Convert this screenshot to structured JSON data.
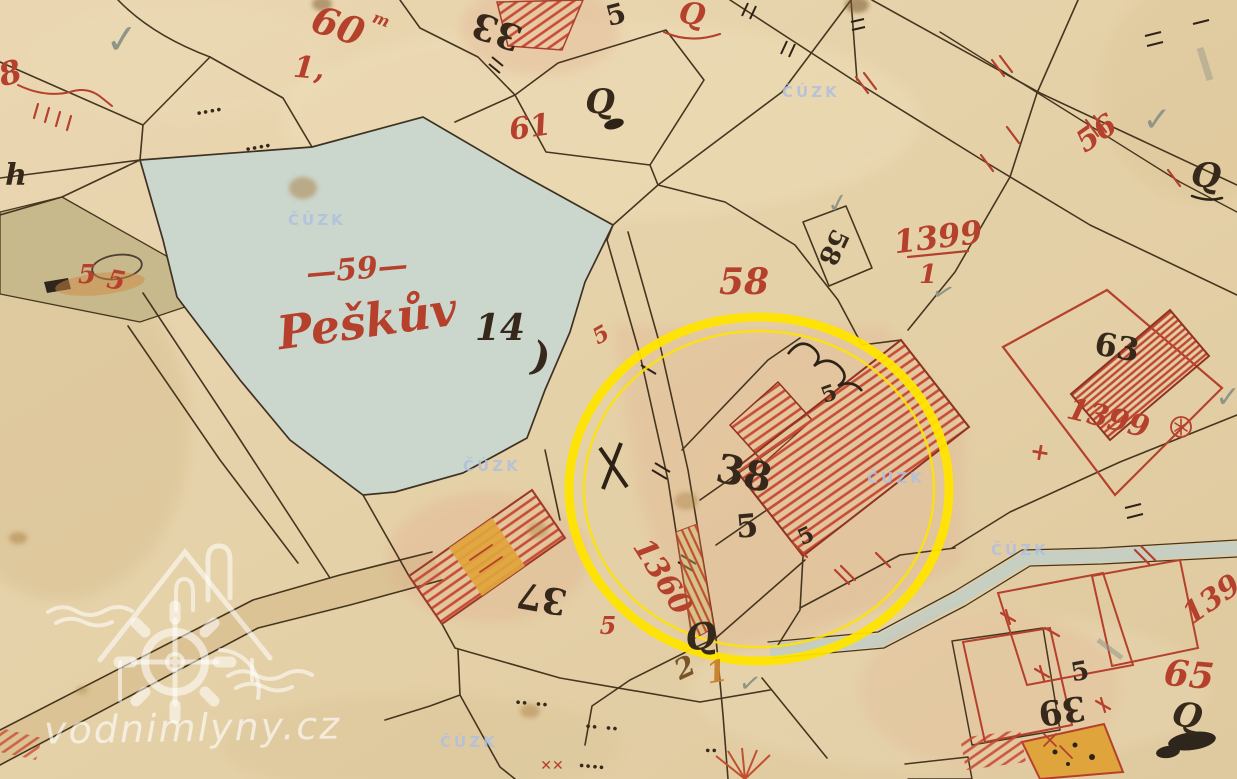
{
  "map": {
    "kind": "historical-cadastral-map",
    "pond_label": {
      "dash_number": "—59—",
      "name": "Peškův",
      "ref": "14)"
    },
    "annotation": {
      "shape": "ellipse",
      "purpose": "highlight of parcel 38 with building",
      "color": "#ffe400"
    },
    "labels": [
      {
        "t": "60",
        "x": 338,
        "y": 26,
        "r": 18,
        "s": 38,
        "c": "red",
        "i": true
      },
      {
        "t": "m",
        "x": 381,
        "y": 20,
        "r": 20,
        "s": 16,
        "c": "red",
        "i": true
      },
      {
        "t": "1,",
        "x": 309,
        "y": 69,
        "r": 5,
        "s": 30,
        "c": "red",
        "i": true
      },
      {
        "t": "33",
        "x": 497,
        "y": 31,
        "r": 200,
        "s": 36,
        "c": "black"
      },
      {
        "t": "5",
        "x": 616,
        "y": 15,
        "r": -15,
        "s": 28,
        "c": "black"
      },
      {
        "t": "Q",
        "x": 692,
        "y": 15,
        "r": 8,
        "s": 30,
        "c": "red",
        "i": true
      },
      {
        "t": "Q",
        "x": 600,
        "y": 102,
        "r": 0,
        "s": 34,
        "c": "black",
        "i": true
      },
      {
        "t": "61",
        "x": 530,
        "y": 128,
        "r": -8,
        "s": 30,
        "c": "red",
        "i": true
      },
      {
        "t": "56",
        "x": 1097,
        "y": 134,
        "r": -35,
        "s": 30,
        "c": "red",
        "i": true
      },
      {
        "t": "Q",
        "x": 1206,
        "y": 176,
        "r": 5,
        "s": 34,
        "c": "black",
        "i": true
      },
      {
        "t": "✓",
        "x": 122,
        "y": 40,
        "r": -5,
        "s": 40,
        "c": "gray"
      },
      {
        "t": "✓",
        "x": 1157,
        "y": 120,
        "r": 0,
        "s": 34,
        "c": "gray"
      },
      {
        "t": "✓",
        "x": 838,
        "y": 204,
        "r": -10,
        "s": 26,
        "c": "gray"
      },
      {
        "t": "—59—",
        "x": 357,
        "y": 270,
        "r": -5,
        "s": 30,
        "c": "red",
        "i": true
      },
      {
        "t": "Peškův",
        "x": 367,
        "y": 321,
        "r": -8,
        "s": 46,
        "c": "red",
        "i": true
      },
      {
        "t": "14",
        "x": 500,
        "y": 328,
        "r": 0,
        "s": 36,
        "c": "black",
        "i": true
      },
      {
        "t": ")",
        "x": 541,
        "y": 358,
        "r": 15,
        "s": 40,
        "c": "black"
      },
      {
        "t": "58",
        "x": 744,
        "y": 282,
        "r": 0,
        "s": 36,
        "c": "red",
        "i": true
      },
      {
        "t": "58",
        "x": 833,
        "y": 247,
        "r": 115,
        "s": 26,
        "c": "black"
      },
      {
        "t": "1399",
        "x": 938,
        "y": 237,
        "r": -7,
        "s": 32,
        "c": "red",
        "i": true
      },
      {
        "t": "1",
        "x": 928,
        "y": 275,
        "r": 0,
        "s": 26,
        "c": "red",
        "i": true
      },
      {
        "t": "✓",
        "x": 943,
        "y": 293,
        "r": 20,
        "s": 26,
        "c": "gray"
      },
      {
        "t": "63",
        "x": 1117,
        "y": 347,
        "r": 10,
        "s": 32,
        "c": "black"
      },
      {
        "t": "1399",
        "x": 1108,
        "y": 419,
        "r": 14,
        "s": 30,
        "c": "red",
        "i": true
      },
      {
        "t": "+",
        "x": 1040,
        "y": 452,
        "r": 10,
        "s": 24,
        "c": "red"
      },
      {
        "t": "38",
        "x": 744,
        "y": 474,
        "r": 12,
        "s": 40,
        "c": "black"
      },
      {
        "t": "5",
        "x": 747,
        "y": 526,
        "r": -5,
        "s": 32,
        "c": "black"
      },
      {
        "t": "5",
        "x": 806,
        "y": 536,
        "r": -25,
        "s": 22,
        "c": "black"
      },
      {
        "t": "5",
        "x": 829,
        "y": 394,
        "r": -20,
        "s": 22,
        "c": "black"
      },
      {
        "t": "1360",
        "x": 662,
        "y": 577,
        "r": 58,
        "s": 30,
        "c": "red",
        "i": true
      },
      {
        "t": "5",
        "x": 608,
        "y": 626,
        "r": 0,
        "s": 24,
        "c": "red",
        "i": true
      },
      {
        "t": "5",
        "x": 601,
        "y": 335,
        "r": -30,
        "s": 22,
        "c": "red",
        "i": true
      },
      {
        "t": "37",
        "x": 542,
        "y": 598,
        "r": 190,
        "s": 36,
        "c": "black"
      },
      {
        "t": "Q",
        "x": 701,
        "y": 637,
        "r": -10,
        "s": 36,
        "c": "black",
        "i": true
      },
      {
        "t": "2",
        "x": 685,
        "y": 668,
        "r": -25,
        "s": 28,
        "c": "brown",
        "i": true
      },
      {
        "t": "1",
        "x": 717,
        "y": 673,
        "r": -10,
        "s": 30,
        "c": "orange",
        "i": true
      },
      {
        "t": "65",
        "x": 1189,
        "y": 675,
        "r": 5,
        "s": 36,
        "c": "red",
        "i": true
      },
      {
        "t": "Q",
        "x": 1187,
        "y": 716,
        "r": 10,
        "s": 34,
        "c": "black",
        "i": true
      },
      {
        "t": "39",
        "x": 1062,
        "y": 710,
        "r": 172,
        "s": 34,
        "c": "black"
      },
      {
        "t": "5",
        "x": 1080,
        "y": 672,
        "r": -10,
        "s": 26,
        "c": "black"
      },
      {
        "t": "139",
        "x": 1212,
        "y": 600,
        "r": -35,
        "s": 30,
        "c": "red",
        "i": true
      },
      {
        "t": "8",
        "x": 10,
        "y": 73,
        "r": -15,
        "s": 32,
        "c": "red",
        "i": true
      },
      {
        "t": "5",
        "x": 87,
        "y": 275,
        "r": 0,
        "s": 26,
        "c": "red",
        "i": true
      },
      {
        "t": "5",
        "x": 116,
        "y": 281,
        "r": 10,
        "s": 26,
        "c": "red",
        "i": true
      },
      {
        "t": "h",
        "x": 16,
        "y": 176,
        "r": 0,
        "s": 30,
        "c": "black",
        "i": true
      },
      {
        "t": "✓",
        "x": 750,
        "y": 684,
        "r": 10,
        "s": 26,
        "c": "gray"
      },
      {
        "t": "✓",
        "x": 1228,
        "y": 398,
        "r": 0,
        "s": 30,
        "c": "gray"
      },
      {
        "t": "✕✕",
        "x": 552,
        "y": 766,
        "r": 0,
        "s": 14,
        "c": "red"
      },
      {
        "t": "‥‥",
        "x": 208,
        "y": 106,
        "r": -10,
        "s": 20,
        "c": "black"
      },
      {
        "t": "‥‥",
        "x": 257,
        "y": 142,
        "r": -10,
        "s": 20,
        "c": "black"
      },
      {
        "t": "‥ ‥",
        "x": 532,
        "y": 698,
        "r": 5,
        "s": 20,
        "c": "black"
      },
      {
        "t": "‥ ‥",
        "x": 602,
        "y": 722,
        "r": 5,
        "s": 20,
        "c": "black"
      },
      {
        "t": "‥‥",
        "x": 592,
        "y": 761,
        "r": 5,
        "s": 20,
        "c": "black"
      },
      {
        "t": "‥",
        "x": 711,
        "y": 745,
        "r": 0,
        "s": 20,
        "c": "black"
      }
    ]
  },
  "watermarks": {
    "site": {
      "text": "vodnimlyny.cz"
    },
    "cuzk": {
      "text": "ČÚZK",
      "positions": [
        {
          "x": 318,
          "y": 220
        },
        {
          "x": 812,
          "y": 92
        },
        {
          "x": 493,
          "y": 466
        },
        {
          "x": 897,
          "y": 478
        },
        {
          "x": 1021,
          "y": 550
        },
        {
          "x": 470,
          "y": 742
        }
      ]
    }
  },
  "palette": {
    "paper": "#e6d2aa",
    "pond": "#cbd6cc",
    "ink_red": "#b5402c",
    "ink_black": "#36291b",
    "building_yellow": "#dfa43c",
    "highlight_circle": "#ffe400",
    "watermark_white": "rgba(255,255,255,0.6)",
    "watermark_blue": "rgba(175,192,222,0.85)"
  }
}
